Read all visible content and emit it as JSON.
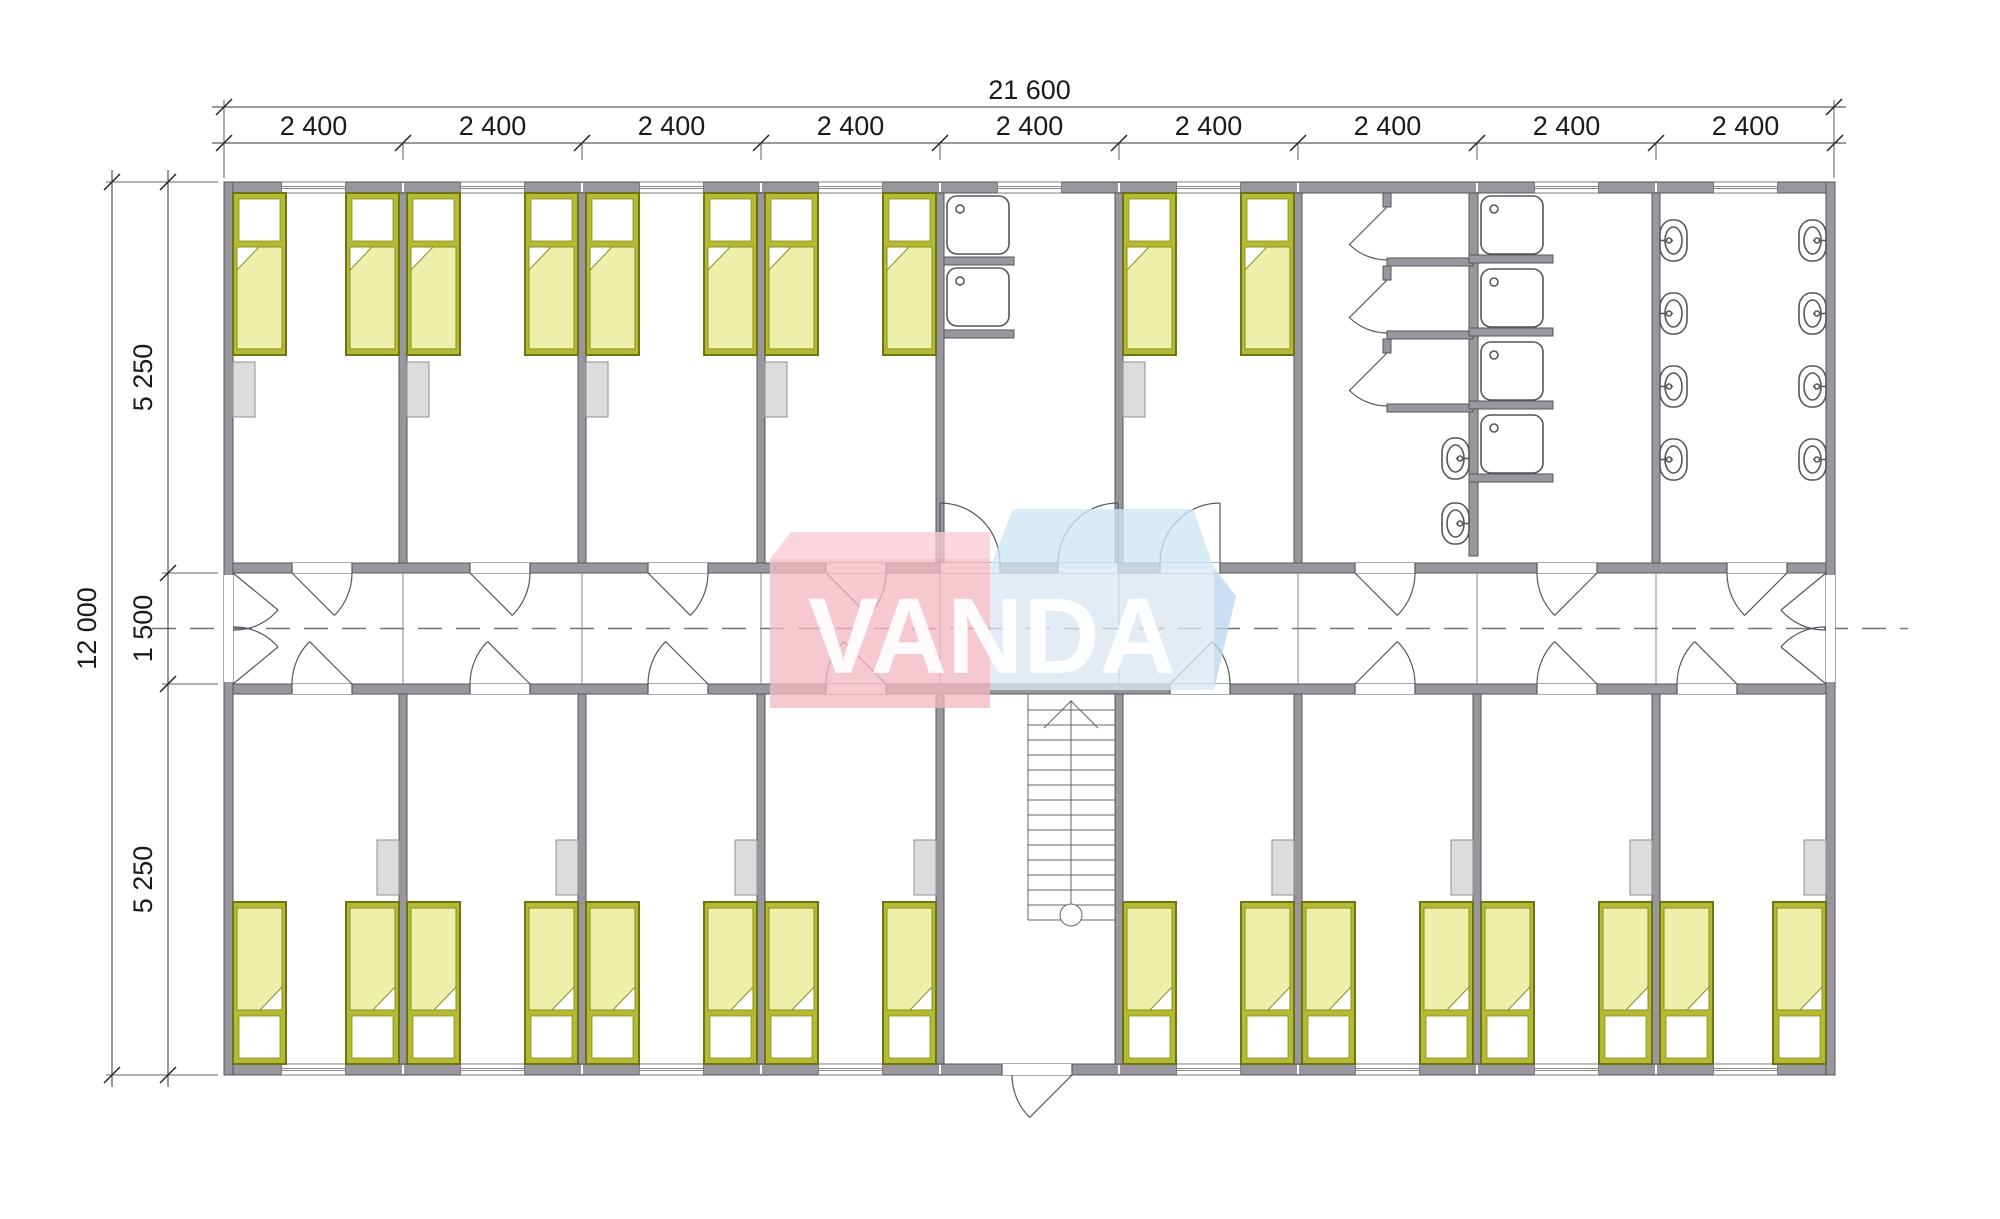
{
  "page": {
    "width": 2000,
    "height": 1219,
    "background": "#ffffff"
  },
  "drawing": {
    "type": "architectural-floor-plan",
    "watermark": {
      "text": "VANDA"
    },
    "dimensions": {
      "top_total": "21 600",
      "top_bays": [
        "2 400",
        "2 400",
        "2 400",
        "2 400",
        "2 400",
        "2 400",
        "2 400",
        "2 400",
        "2 400"
      ],
      "left_total": "12 000",
      "left_segments": [
        "5 250",
        "1 500",
        "5 250"
      ]
    },
    "inventory": {
      "single_beds": 26,
      "wardrobes": 13,
      "kitchen_sinks": 2,
      "toilet_stalls": 3,
      "shower_trays": 4,
      "wash_basins": 10,
      "staircases": 1,
      "room_doors": 18,
      "corridor_end_doors": 2,
      "entrance_doors": 1
    },
    "colors": {
      "wall": "#97979d",
      "wall_stroke": "#55555c",
      "thin_line": "#8a8a8a",
      "centerline": "#707070",
      "bed_frame": "#b5ba33",
      "bed_frame_stroke": "#6e7313",
      "bed_blanket": "#edf0aa",
      "bed_blanket_stroke": "#8a8f1f",
      "wardrobe": "#dcdcdc",
      "wardrobe_stroke": "#8f8f8f",
      "fixture_stroke": "#56565c",
      "door_stroke": "#555560",
      "watermark_red_top": "#f7ccd2",
      "watermark_red_front": "#f3b9c1",
      "watermark_blue_top": "#cfe6f6",
      "watermark_blue_front": "#dbe5f1",
      "watermark_blue_side": "#bdd6ee",
      "watermark_text": "#ffffff",
      "dimension_text": "#1a1a1a",
      "dimension_line": "#333333"
    }
  }
}
